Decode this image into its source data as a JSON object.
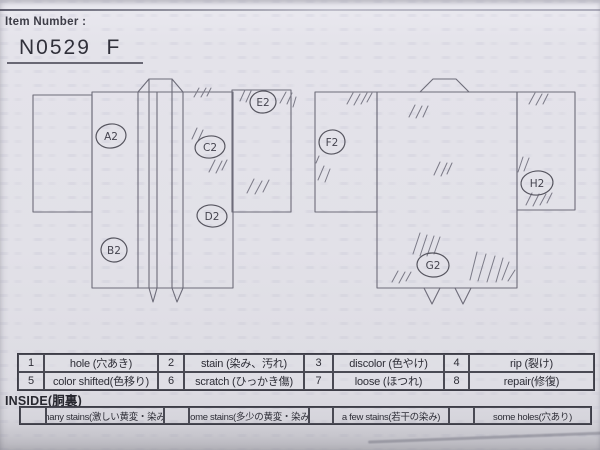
{
  "header": {
    "label": "Item Number :",
    "value": "N0529  F"
  },
  "diagram": {
    "markers": [
      {
        "label": "A2",
        "view": "front"
      },
      {
        "label": "B2",
        "view": "front"
      },
      {
        "label": "C2",
        "view": "front"
      },
      {
        "label": "D2",
        "view": "front"
      },
      {
        "label": "E2",
        "view": "front"
      },
      {
        "label": "F2",
        "view": "back"
      },
      {
        "label": "G2",
        "view": "back"
      },
      {
        "label": "H2",
        "view": "back"
      }
    ]
  },
  "legend": {
    "items": [
      {
        "num": "1",
        "label": "hole (穴あき)"
      },
      {
        "num": "2",
        "label": "stain (染み、汚れ)"
      },
      {
        "num": "3",
        "label": "discolor (色やけ)"
      },
      {
        "num": "4",
        "label": "rip (裂け)"
      },
      {
        "num": "5",
        "label": "color shifted(色移り)"
      },
      {
        "num": "6",
        "label": "scratch (ひっかき傷)"
      },
      {
        "num": "7",
        "label": "loose (ほつれ)"
      },
      {
        "num": "8",
        "label": "repair(修復)"
      }
    ]
  },
  "inside": {
    "heading": "INSIDE(胴裏)",
    "options": [
      {
        "label": "many stains(激しい黄変・染み)"
      },
      {
        "label": "some stains(多少の黄変・染み)"
      },
      {
        "label": "a few stains(若干の染み)"
      },
      {
        "label": "some holes(穴あり)"
      }
    ]
  },
  "colors": {
    "paper": "#e2e1e8",
    "ink": "#6d6c79",
    "table_line": "#3d3d47",
    "text": "#2d2d36"
  }
}
